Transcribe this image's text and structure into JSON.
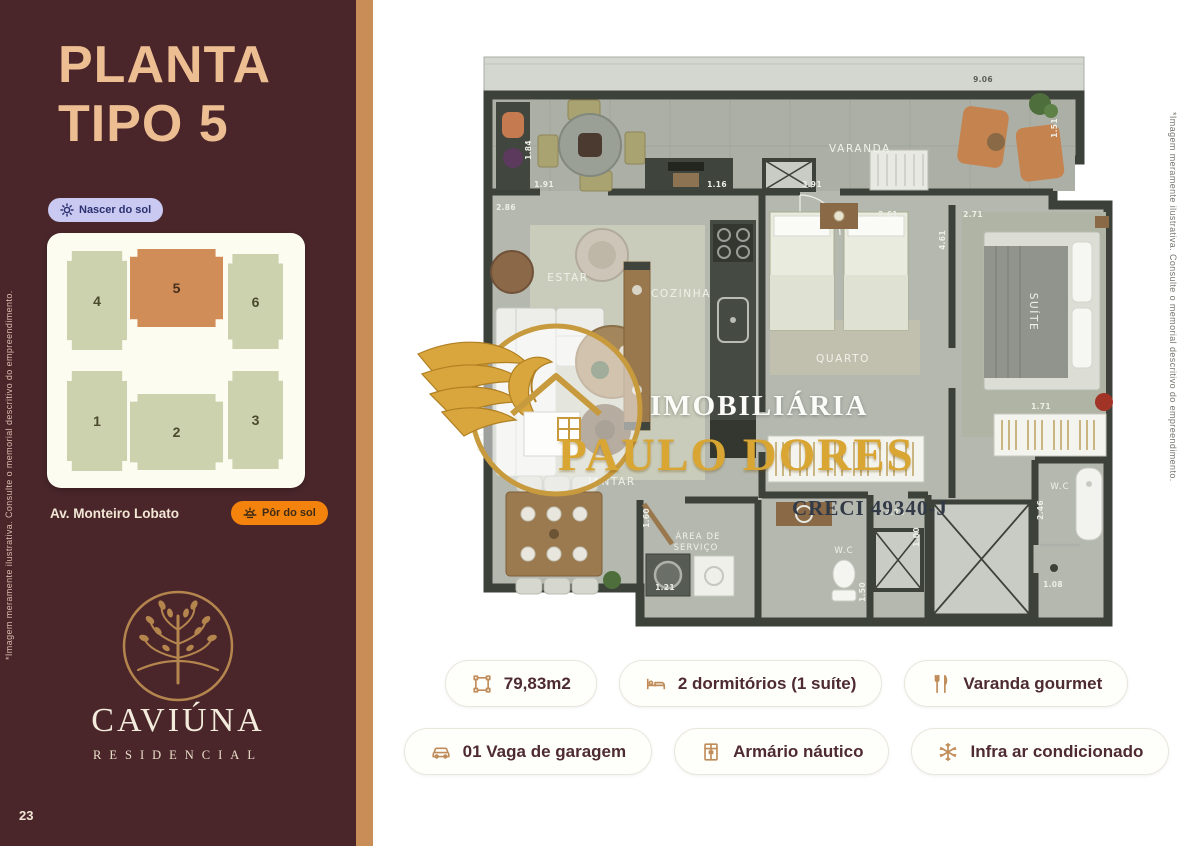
{
  "page": {
    "number": "23",
    "disclaimer": "*Imagem meramente ilustrativa. Consulte o memorial descritivo do empreendimento."
  },
  "sidebar": {
    "title_line1": "PLANTA",
    "title_line2": "TIPO 5",
    "sunrise_label": "Nascer do sol",
    "sunset_label": "Pôr do sol",
    "street_label": "Av. Monteiro Lobato",
    "units": [
      {
        "number": "4"
      },
      {
        "number": "5"
      },
      {
        "number": "6"
      },
      {
        "number": "1"
      },
      {
        "number": "2"
      },
      {
        "number": "3"
      }
    ],
    "brand_name": "CAVIÚNA",
    "brand_subtitle": "RESIDENCIAL"
  },
  "watermark": {
    "line1": "IMOBILIÁRIA",
    "line2": "PAULO DORES",
    "line3": "CRECI 49340-J"
  },
  "floor_plan": {
    "labels": {
      "varanda": "VARANDA",
      "estar": "ESTAR",
      "cozinha": "COZINHA",
      "quarto": "QUARTO",
      "suite": "SUÍTE",
      "jantar": "JANTAR",
      "servico1": "ÁREA  DE",
      "servico2": "SERVIÇO",
      "wc": "W.C",
      "wc_suite": "W.C"
    },
    "dims": {
      "d906": "9.06",
      "d184": "1.84",
      "d191": "1.91",
      "d286": "2.86",
      "d116": "1.16",
      "d391": "3.91",
      "d261": "2.61",
      "d461": "4.61",
      "d271": "2.71",
      "d151": "1.51",
      "d171": "1.71",
      "d226": "2.26",
      "d100": "1.00",
      "d246": "2.46",
      "d108": "1.08",
      "d121": "1.21",
      "d160": "1.60",
      "d150": "1.50",
      "d601": "6.01"
    }
  },
  "features": [
    {
      "label": "79,83m2"
    },
    {
      "label": "2 dormitórios (1 suíte)"
    },
    {
      "label": "Varanda gourmet"
    },
    {
      "label": "01 Vaga de garagem"
    },
    {
      "label": "Armário náutico"
    },
    {
      "label": "Infra ar condicionado"
    }
  ]
}
